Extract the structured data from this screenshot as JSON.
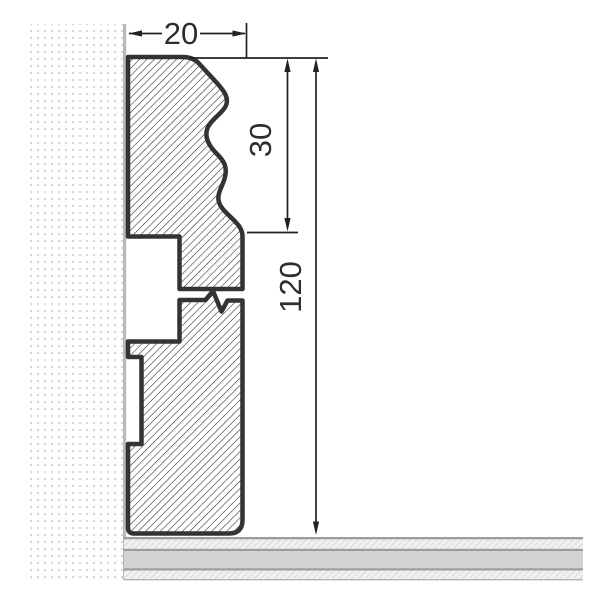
{
  "meta": {
    "title": "Skirting board profile cross-section with dimensions",
    "drawing_type": "dimensioned technical section"
  },
  "dimensions": {
    "width_mm": "20",
    "top_section_mm": "30",
    "height_mm": "120"
  },
  "parts": {
    "wall": "wall-section-dotted",
    "floor": "floor-section-layered",
    "profile": "skirting-profile-hatched",
    "break_symbol": "height-break-zigzag"
  },
  "colors": {
    "outline": "#333333",
    "hatch_line": "#1b1b1b",
    "dim_line": "#222222",
    "label_text": "#2d2d2d",
    "wall_dot": "#d6d6d6",
    "wall_surface_line": "#b9b9b9",
    "floor_border": "#9c9c9c",
    "floor_solid": "#d2d2d2",
    "floor_hatch_bg": "#f0f0f0",
    "floor_hatch_line": "#c5c5c5",
    "background": "#ffffff"
  }
}
